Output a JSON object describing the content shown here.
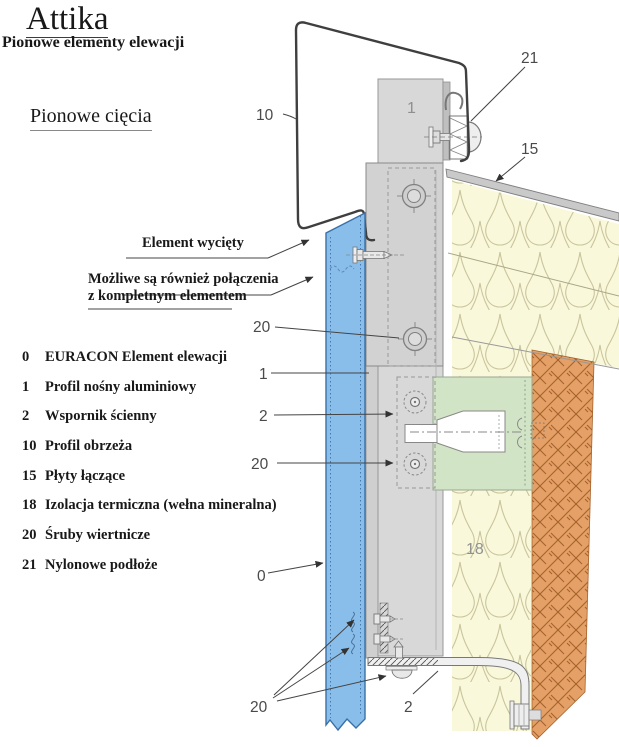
{
  "title": "Attika",
  "subtitle": "Pionowe elementy elewacji",
  "section_heading": "Pionowe cięcia",
  "annotations": {
    "cutout_label": "Element wycięty",
    "alt_connection_line1": "Możliwe są również połączenia",
    "alt_connection_line2": "z kompletnym elementem"
  },
  "legend": {
    "items": [
      {
        "num": "0",
        "label": "EURACON Element elewacji"
      },
      {
        "num": "1",
        "label": "Profil nośny aluminiowy"
      },
      {
        "num": "2",
        "label": "Wspornik ścienny"
      },
      {
        "num": "10",
        "label": "Profil obrzeża"
      },
      {
        "num": "15",
        "label": "Płyty łączące"
      },
      {
        "num": "18",
        "label": "Izolacja termiczna (wełna mineralna)"
      },
      {
        "num": "20",
        "label": "Śruby wiertnicze"
      },
      {
        "num": "21",
        "label": "Nylonowe podłoże"
      }
    ]
  },
  "callouts": {
    "profile_edge": "10",
    "nylon_pad": "21",
    "connecting_plate": "15",
    "screws_top": "20",
    "profile": "1",
    "bracket": "2",
    "screws_mid": "20",
    "facade_element": "0",
    "screws_bottom": "20",
    "bracket_bottom": "2",
    "profile_inline": "1",
    "insulation_inline": "18"
  },
  "colors": {
    "facade_panel_blue": "#8abeea",
    "bracket_green": "#d2e4c6",
    "insulation_yellow": "#faf8db",
    "brick_orange": "#e4a066",
    "profile_gray": "#d7d7d7"
  }
}
